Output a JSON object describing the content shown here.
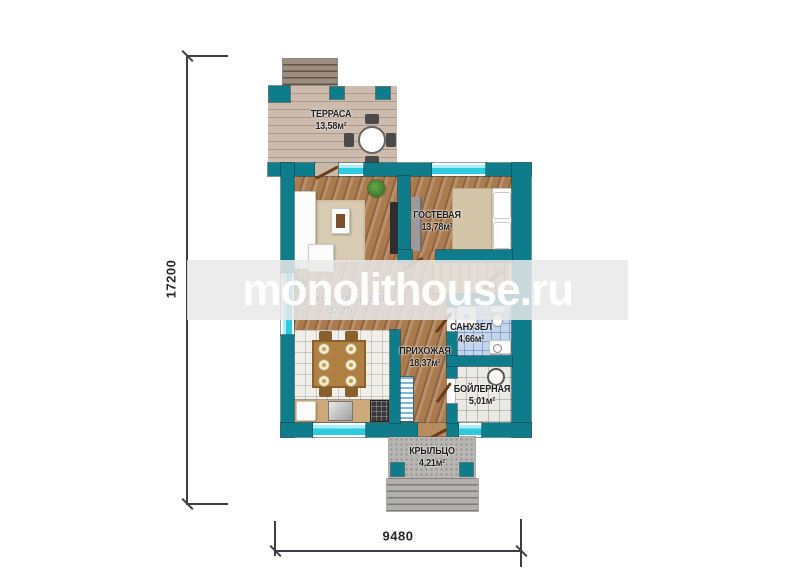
{
  "watermark": {
    "text": "monolithouse.ru"
  },
  "dimensions": {
    "vertical": "17200",
    "horizontal": "9480"
  },
  "rooms": [
    {
      "name": "ТЕРРАСА",
      "area": "13,58м²"
    },
    {
      "name": "ГОСТЕВАЯ",
      "area": "13,78м²"
    },
    {
      "name": "КУХНЯ-ГОСТИНАЯ",
      "area": "37,27м²"
    },
    {
      "name": "САНУЗЕЛ",
      "area": "4,66м²"
    },
    {
      "name": "ПРИХОЖАЯ",
      "area": "18,37м²"
    },
    {
      "name": "БОЙЛЕРНАЯ",
      "area": "5,01м²"
    },
    {
      "name": "КРЫЛЬЦО",
      "area": "4,21м²"
    }
  ],
  "colors": {
    "wall": "#0f7c8c",
    "window_glass": "#2fc9e0",
    "wood_floor": "#ab7b50",
    "kitchen_tile": "#f0efea",
    "bath_tile": "#c2d5ec",
    "boiler_tile": "#ebe9e3",
    "porch_concrete": "#b8b6b3",
    "door_leaf": "#6e3b1c",
    "dim_line": "#3d3d45"
  }
}
